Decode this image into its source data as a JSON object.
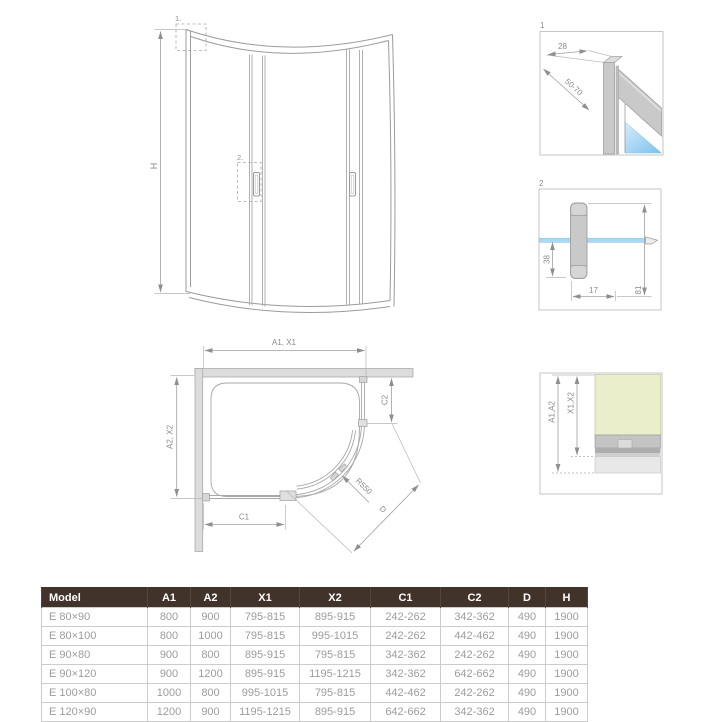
{
  "drawings": {
    "front_view": {
      "height_dim": "H",
      "detail_marker_1": "1.",
      "detail_marker_2": "2."
    },
    "detail_1": {
      "number": "1",
      "dim_profile_width": "28",
      "dim_adjust_range": "50-70"
    },
    "detail_2": {
      "number": "2",
      "dim_handle_offset": "38",
      "dim_handle_depth": "17",
      "dim_handle_height": "81"
    },
    "plan_view": {
      "dim_top": "A1, X1",
      "dim_left": "A2, X2",
      "dim_c1": "C1",
      "dim_c2": "C2",
      "dim_radius": "R550",
      "dim_door": "D"
    },
    "wall_section": {
      "dim_a": "A1,A2",
      "dim_x": "X1,X2"
    }
  },
  "colors": {
    "table_header_bg": "#42332a",
    "table_header_text": "#ffffff",
    "table_cell_text": "#9c9c9c",
    "table_border": "#cccccc",
    "drawing_line": "#9b9b9b",
    "dim_text": "#8a8a8a",
    "glass_blue": "#a9d9f3",
    "wall_yellow": "#eaeecb",
    "profile_gray": "#c6c6c6",
    "floor_gray": "#e8e8e8",
    "wall_gray": "#dcdcdc"
  },
  "table": {
    "columns": [
      "Model",
      "A1",
      "A2",
      "X1",
      "X2",
      "C1",
      "C2",
      "D",
      "H"
    ],
    "column_widths": [
      106,
      43,
      40,
      69,
      71,
      70,
      68,
      37,
      42
    ],
    "rows": [
      [
        "E 80×90",
        "800",
        "900",
        "795-815",
        "895-915",
        "242-262",
        "342-362",
        "490",
        "1900"
      ],
      [
        "E 80×100",
        "800",
        "1000",
        "795-815",
        "995-1015",
        "242-262",
        "442-462",
        "490",
        "1900"
      ],
      [
        "E 90×80",
        "900",
        "800",
        "895-915",
        "795-815",
        "342-362",
        "242-262",
        "490",
        "1900"
      ],
      [
        "E 90×120",
        "900",
        "1200",
        "895-915",
        "1195-1215",
        "342-362",
        "642-662",
        "490",
        "1900"
      ],
      [
        "E 100×80",
        "1000",
        "800",
        "995-1015",
        "795-815",
        "442-462",
        "242-262",
        "490",
        "1900"
      ],
      [
        "E 120×90",
        "1200",
        "900",
        "1195-1215",
        "895-915",
        "642-662",
        "342-362",
        "490",
        "1900"
      ]
    ]
  }
}
